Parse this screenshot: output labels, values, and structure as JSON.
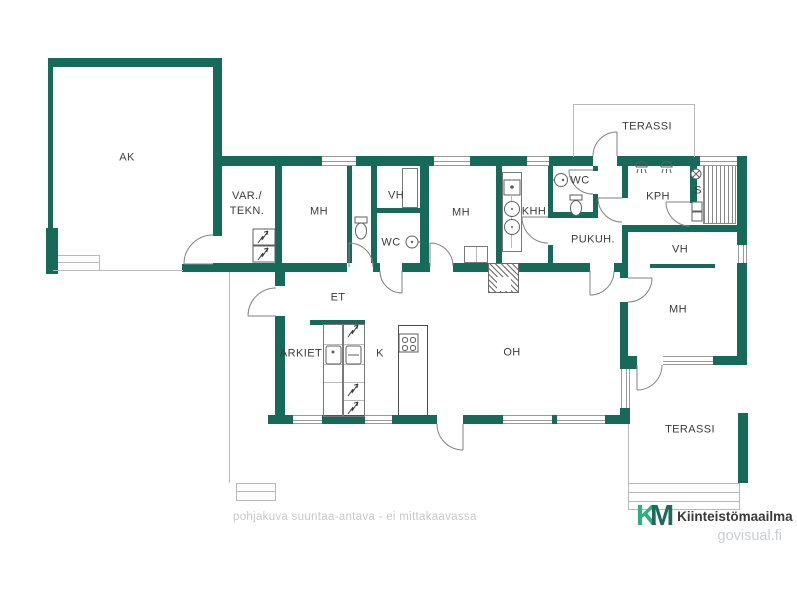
{
  "meta": {
    "type": "floor-plan",
    "language": "Finnish"
  },
  "colors": {
    "wall": "#17695a",
    "window_line": "#9a9a9a",
    "outline_gray": "#b9b9b9",
    "furniture": "#787878",
    "symbol": "#5f5f5f",
    "label_text": "#3c3c3c",
    "footer_text": "#c8c8c8",
    "logo_k": "#2fae7e",
    "logo_m": "#1e6b5c",
    "brand_text": "#3a3a3a",
    "site_text": "#c9d0d5"
  },
  "rooms": {
    "ak": "AK",
    "var_line1": "VAR./",
    "var_line2": "TEKN.",
    "mh1": "MH",
    "vh1": "VH",
    "wc1": "WC",
    "mh2": "MH",
    "khh": "KHH",
    "wc2": "WC",
    "pukuh": "PUKUH.",
    "kph": "KPH",
    "sauna": "S",
    "terassi_top": "TERASSI",
    "vh2": "VH",
    "mh3": "MH",
    "terassi_bottom": "TERASSI",
    "et": "ET",
    "arkiet": "ARKIET",
    "kitchen": "K",
    "oh": "OH"
  },
  "icons": {
    "toilet-icon": "ellipse-bowl-with-tank",
    "sink-icon": "circle-with-dot",
    "shower-icon": "semicircle-with-spray-lines",
    "stove-icon": "four-burner-circles",
    "sauna-heater-icon": "circle-with-crosshatch",
    "washing-machine-icon": "circle-with-center-dot",
    "lightning-icon": "zigzag-arrow",
    "fireplace-icon": "diagonal-hatch-square",
    "door-icon": "quarter-arc-swing",
    "window-icon": "double-line-wall-gap",
    "sauna-bench-icon": "vertical-slats"
  },
  "footer": {
    "note": "pohjakuva suuntaa-antava - ei mittakaavassa"
  },
  "branding": {
    "logo_k": "K",
    "logo_m": "M",
    "company": "Kiinteistömaailma",
    "website": "govisual.fi"
  }
}
